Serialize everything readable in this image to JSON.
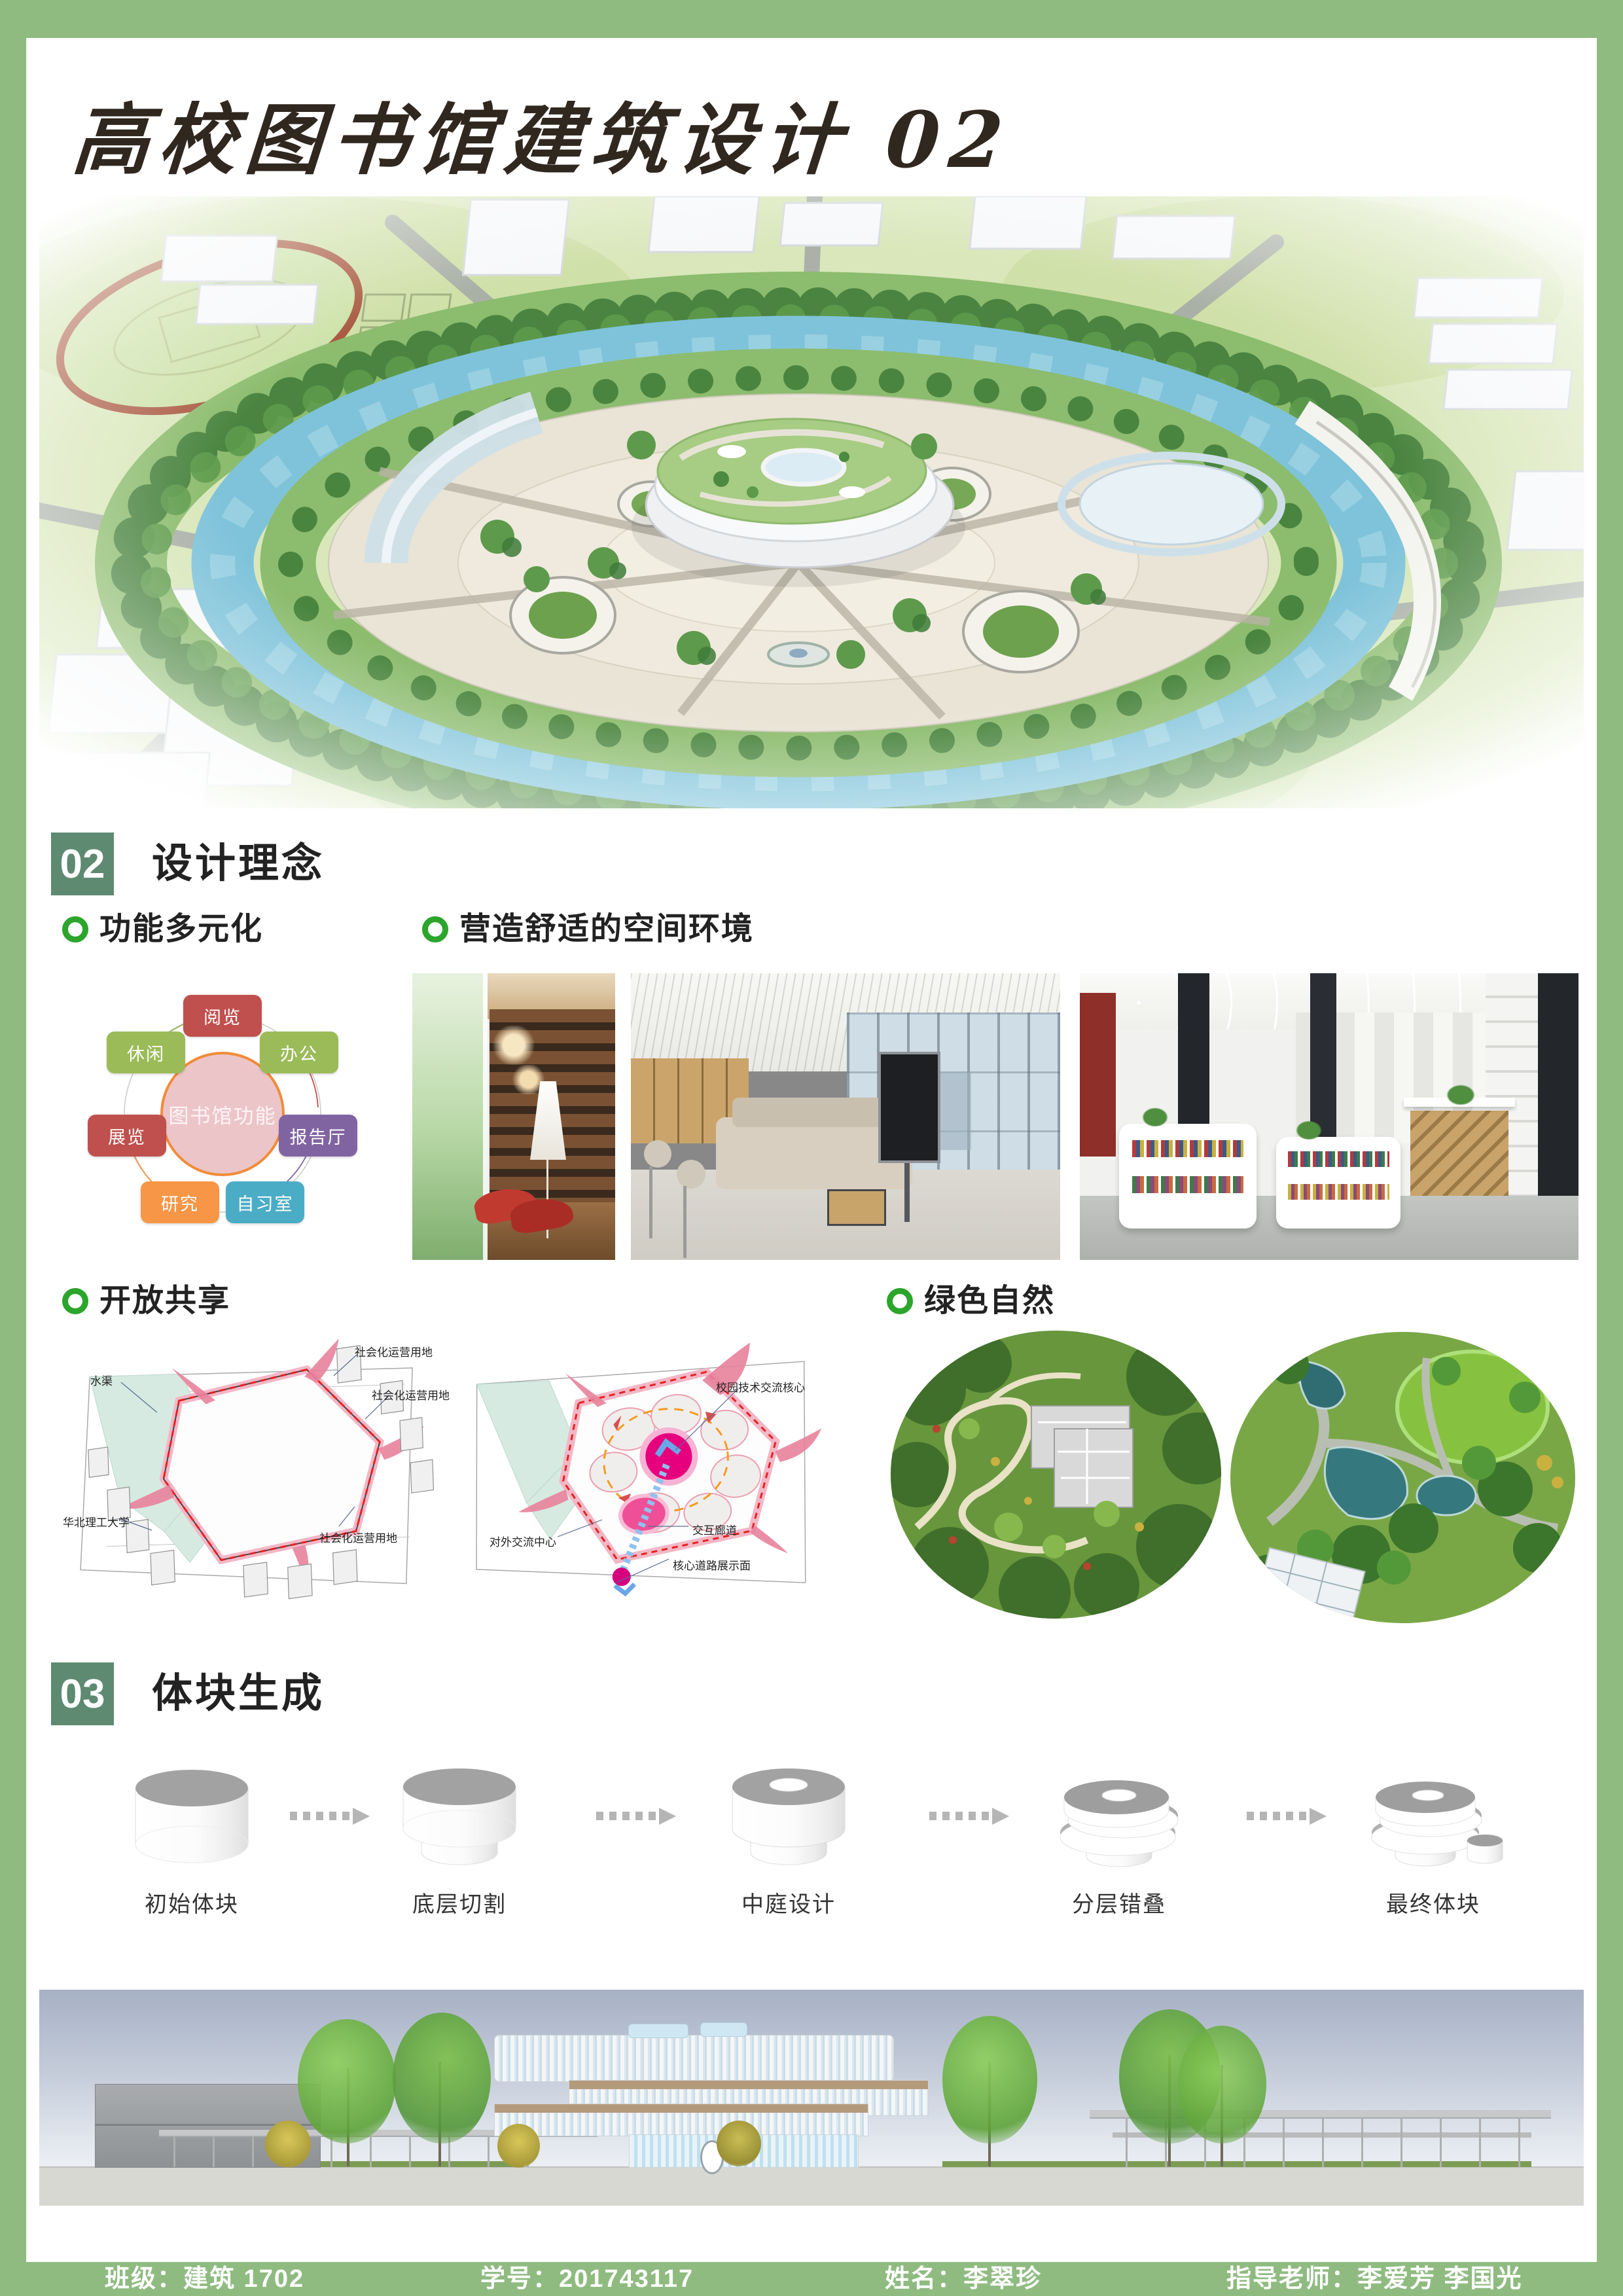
{
  "page": {
    "title": "高校图书馆建筑设计 02"
  },
  "colors": {
    "frame_green": "#8fbb81",
    "badge_green": "#5d8a71",
    "bullet_green": "#2ba52b",
    "title_ink": "#30271f"
  },
  "section02": {
    "number": "02",
    "title": "设计理念"
  },
  "section03": {
    "number": "03",
    "title": "体块生成"
  },
  "subsections": {
    "function": "功能多元化",
    "comfort": "营造舒适的空间环境",
    "open": "开放共享",
    "green": "绿色自然"
  },
  "function_diagram": {
    "center": "图书馆功能",
    "nodes": [
      {
        "label": "阅览",
        "color": "#c0504d"
      },
      {
        "label": "办公",
        "color": "#9bbb59"
      },
      {
        "label": "报告厅",
        "color": "#8064a2"
      },
      {
        "label": "自习室",
        "color": "#4bacc6"
      },
      {
        "label": "研究",
        "color": "#f79646"
      },
      {
        "label": "展览",
        "color": "#c0504d"
      },
      {
        "label": "休闲",
        "color": "#9bbb59"
      }
    ]
  },
  "site_left": {
    "water": "水渠",
    "social1": "社会化运营用地",
    "social2": "社会化运营用地",
    "social3": "社会化运营用地",
    "university": "华北理工大学"
  },
  "site_right": {
    "core": "校园技术交流核心",
    "external": "对外交流中心",
    "corridor": "交互廊道",
    "road": "核心道路展示面"
  },
  "massing_steps": [
    {
      "label": "初始体块"
    },
    {
      "label": "底层切割"
    },
    {
      "label": "中庭设计"
    },
    {
      "label": "分层错叠"
    },
    {
      "label": "最终体块"
    }
  ],
  "footer": {
    "class": "班级：建筑 1702",
    "student_id": "学号：201743117",
    "name": "姓名：李翠珍",
    "advisor": "指导老师：李爱芳 李国光"
  }
}
